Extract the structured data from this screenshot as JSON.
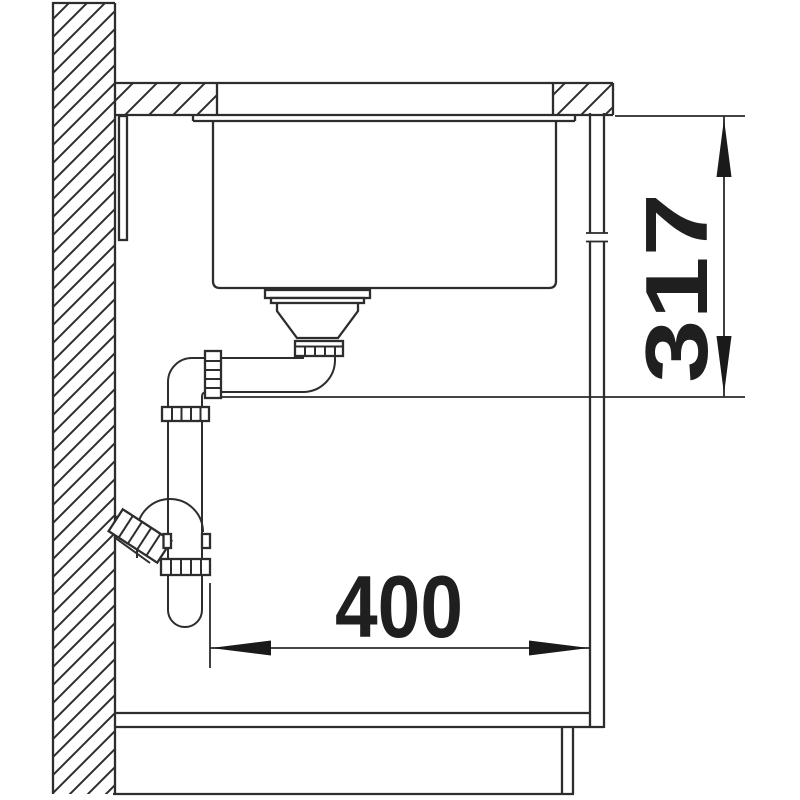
{
  "diagram": {
    "dimensions": {
      "vertical_value": "317",
      "horizontal_value": "400"
    },
    "colors": {
      "line": "#2d2d2d",
      "dimension_text": "#1f1f1f",
      "background": "#ffffff"
    }
  }
}
